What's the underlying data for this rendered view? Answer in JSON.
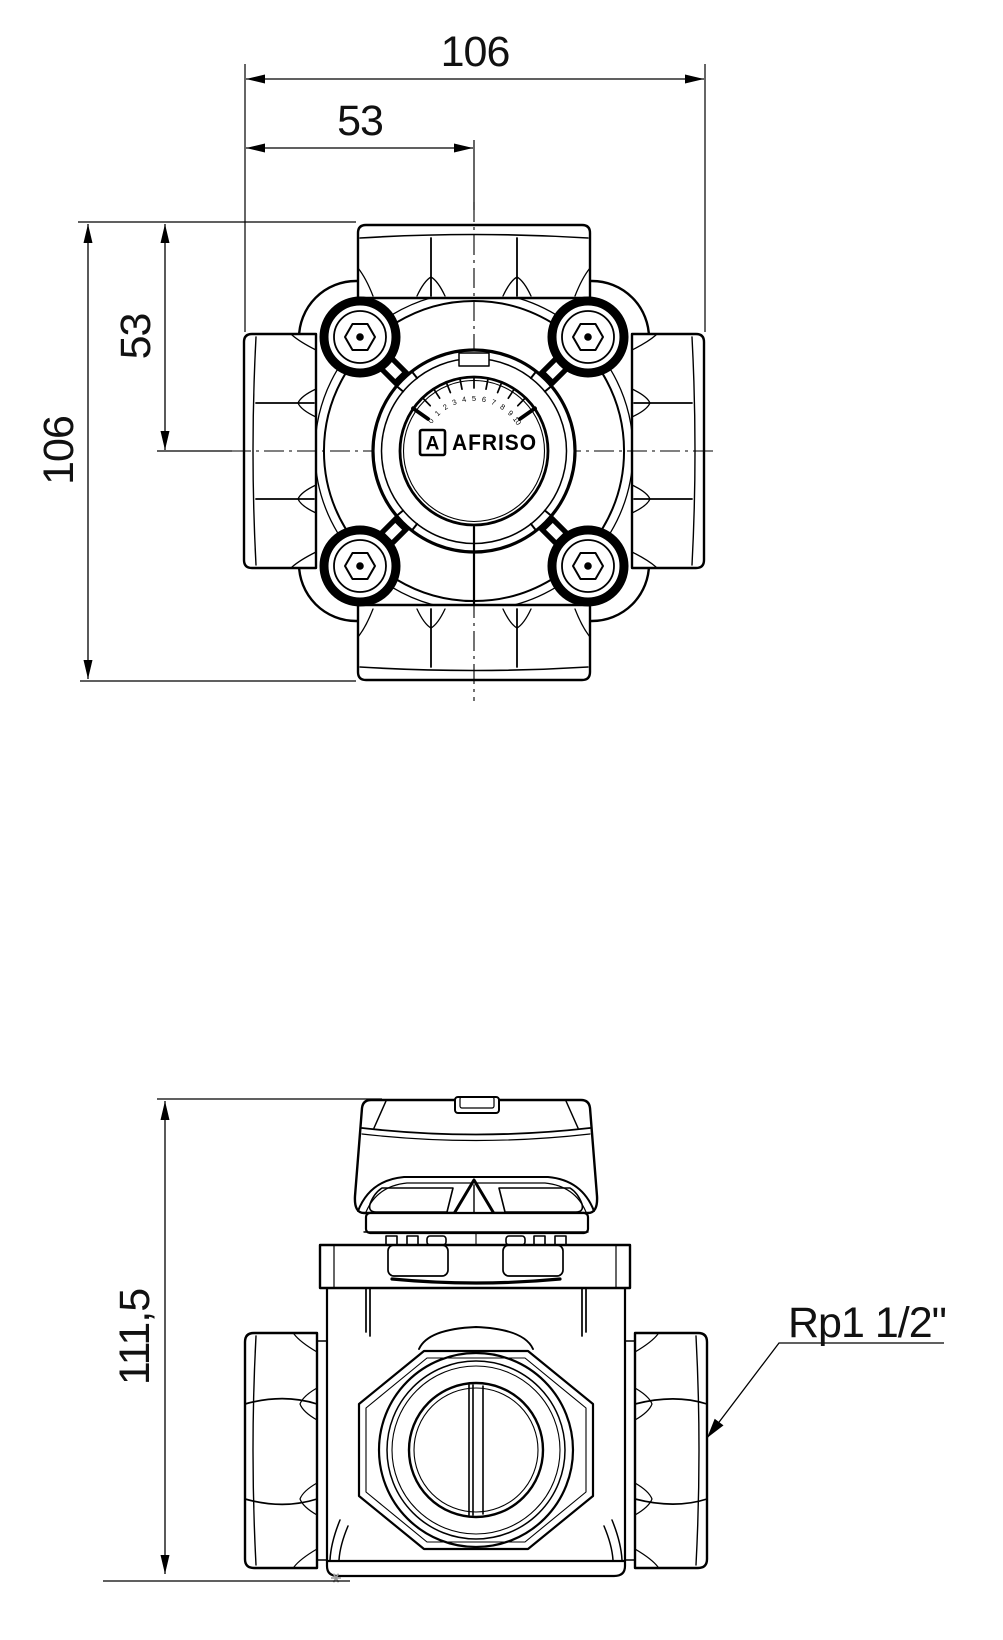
{
  "top_view": {
    "dimensions": {
      "width_total": "106",
      "width_half": "53",
      "height_half": "53",
      "height_total": "106"
    },
    "dial": {
      "brand": "AFRISO",
      "logo_letter": "A",
      "scale_labels": [
        "0",
        "1",
        "2",
        "3",
        "4",
        "5",
        "6",
        "7",
        "8",
        "9",
        "10"
      ]
    }
  },
  "front_view": {
    "dimensions": {
      "height_total": "111,5"
    },
    "connection_label": "Rp1 1/2\""
  }
}
